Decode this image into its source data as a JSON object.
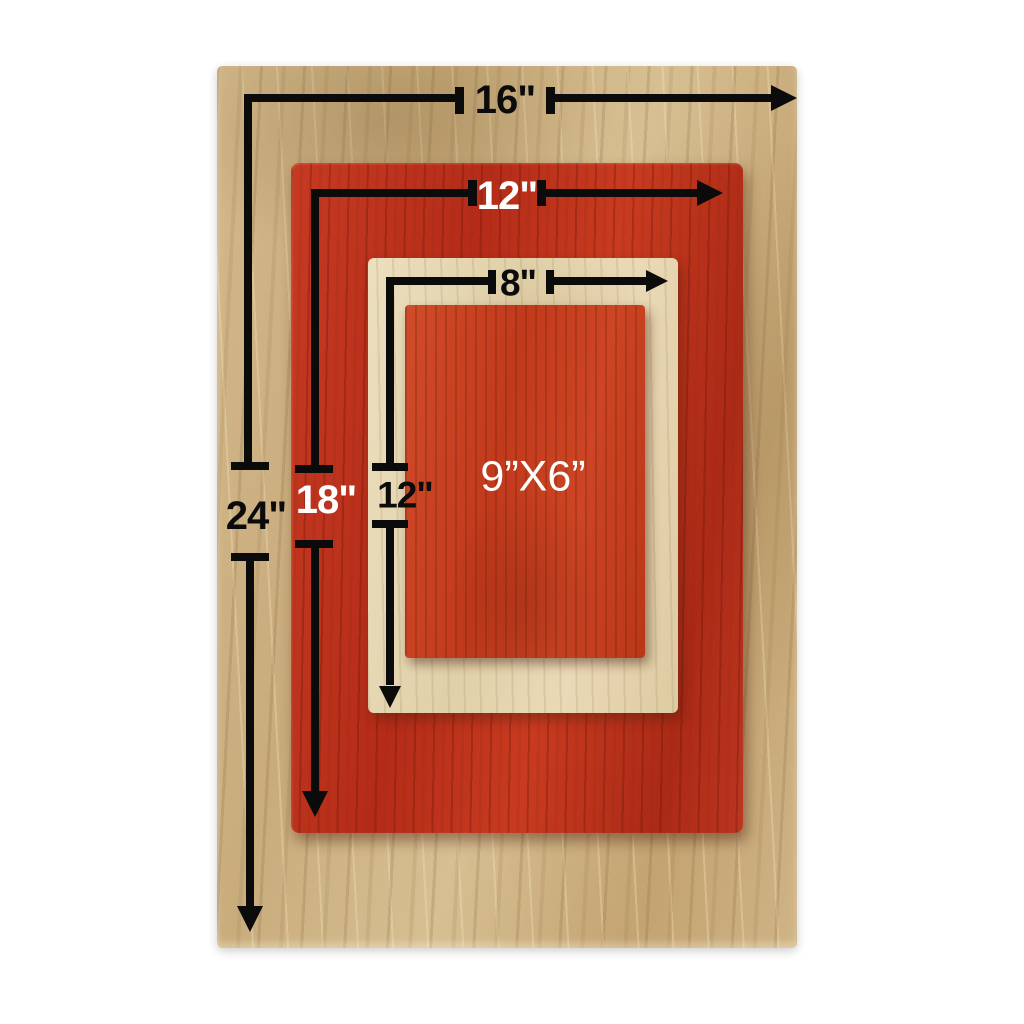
{
  "labels": {
    "outer_width": "16\"",
    "outer_height": "24\"",
    "red_width": "12\"",
    "red_height": "18\"",
    "cream_width": "8\"",
    "cream_height": "12\"",
    "inner_board": "9”X6”"
  },
  "colors": {
    "annotation_black": "#0b0b0b",
    "label_white": "#ffffff",
    "outer_board_wood": "#cdb183",
    "red_board": "#bf3520",
    "cream_board": "#e5d6b2",
    "inner_red_board": "#c64424",
    "background": "#ffffff"
  }
}
